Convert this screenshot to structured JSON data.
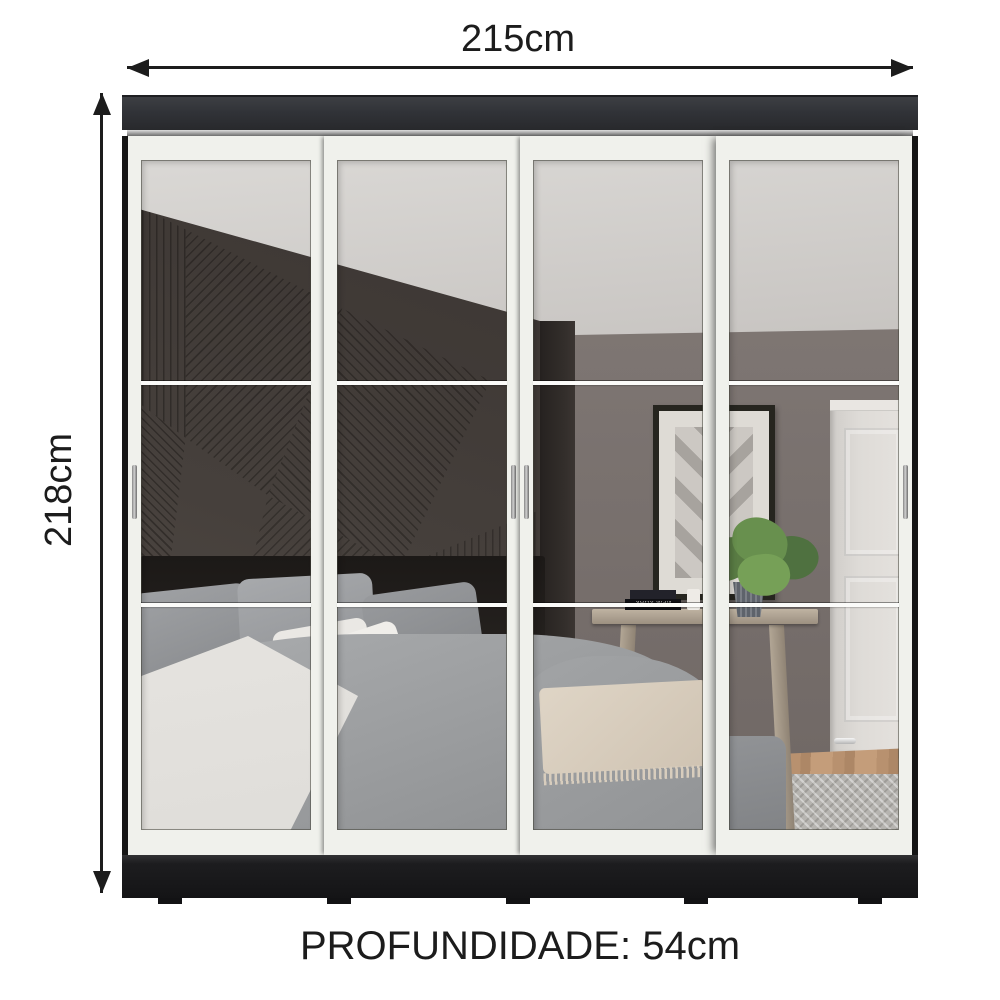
{
  "dimensions": {
    "width_label": "215cm",
    "height_label": "218cm",
    "depth_label": "PROFUNDIDADE: 54cm"
  },
  "wardrobe": {
    "door_count": 4,
    "reflection": {
      "book_spine_text": "NEW YORK"
    }
  },
  "colors": {
    "page": "#ffffff",
    "dim": "#1c1c1c",
    "frame": "#f0f1ec",
    "crown": "#313338",
    "carcass": "#161616",
    "plinth": "#1d1d1f",
    "accent_wall": "#46403c",
    "wall": "#7b7370",
    "ceiling": "#cac7c4",
    "duvet": "#9b9d9f",
    "wood_floor": "#b8916f",
    "rug": "#b6b4b0",
    "foliage": "#68904e"
  }
}
